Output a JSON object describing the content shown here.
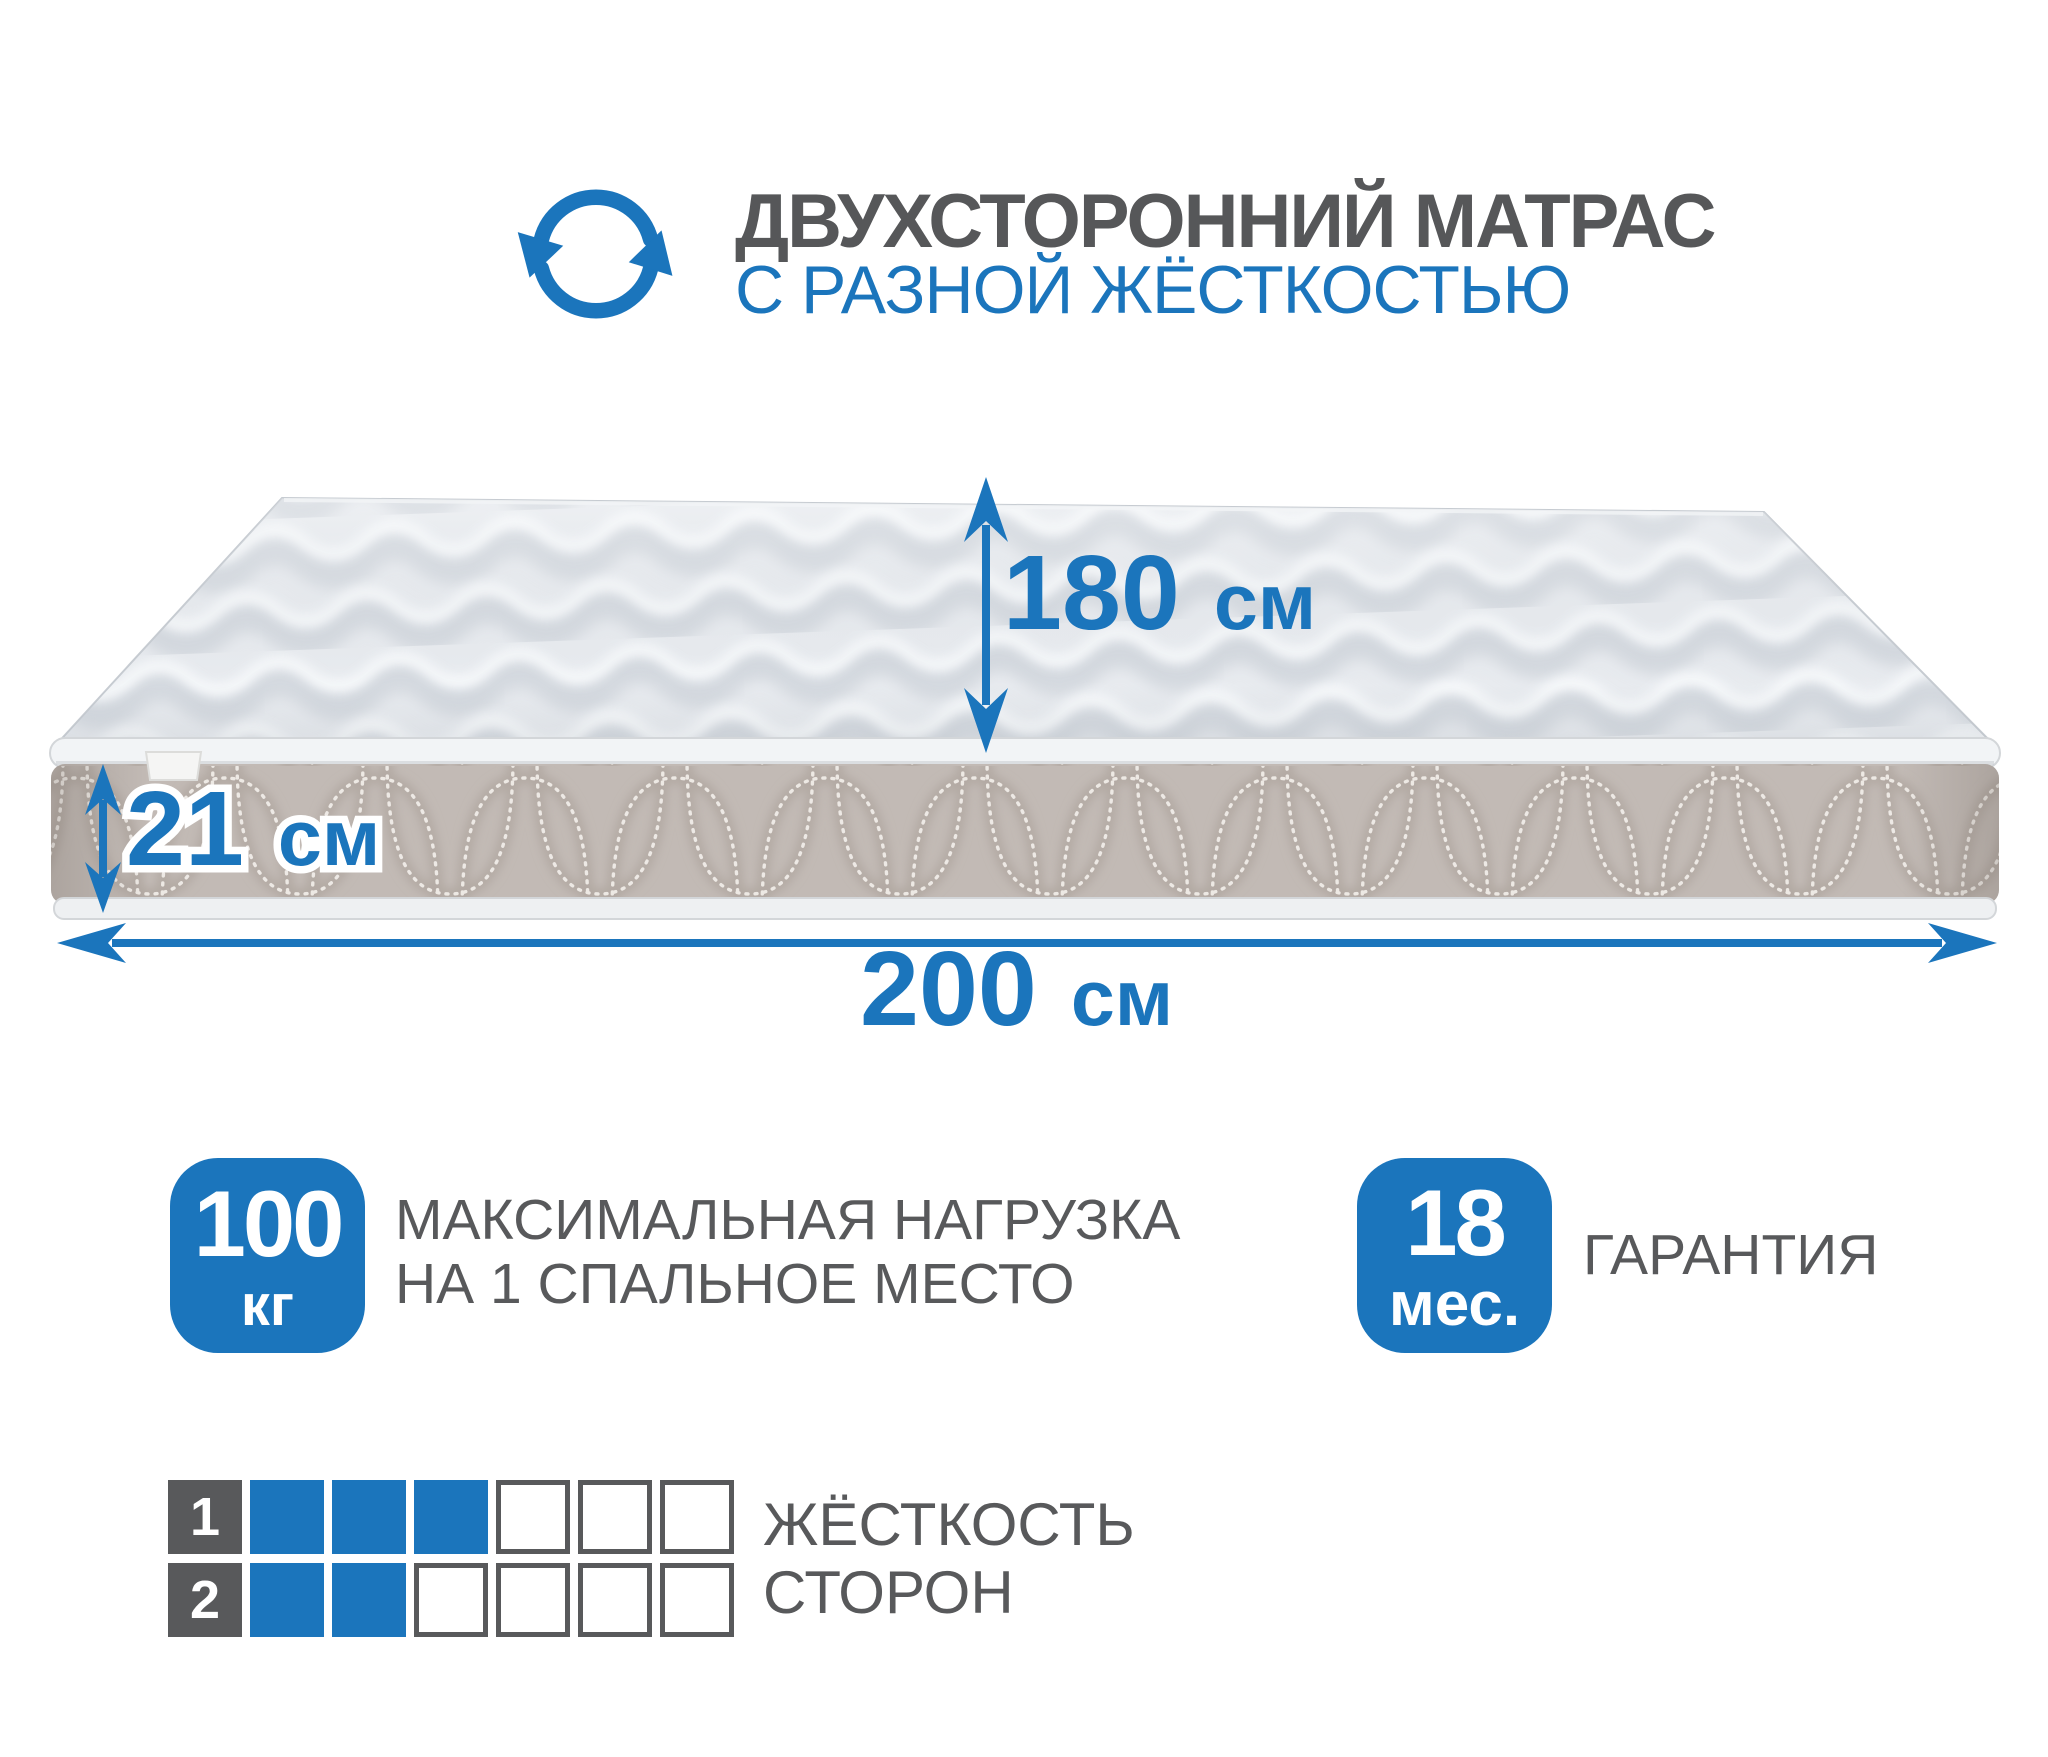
{
  "colors": {
    "accent": "#1b75bc",
    "text_gray": "#58595b"
  },
  "icons": {
    "header": "rotate-arrows-icon"
  },
  "header": {
    "title": "ДВУХСТОРОННИЙ МАТРАС",
    "subtitle": "С РАЗНОЙ ЖЁСТКОСТЬЮ"
  },
  "dimensions": {
    "width": {
      "value": "180",
      "unit": "см"
    },
    "height": {
      "value": "21",
      "unit": "см"
    },
    "length": {
      "value": "200",
      "unit": "см"
    }
  },
  "badges": {
    "max_load": {
      "value": "100",
      "unit": "кг",
      "label_line1": "МАКСИМАЛЬНАЯ НАГРУЗКА",
      "label_line2": "НА 1 СПАЛЬНОЕ МЕСТО"
    },
    "warranty": {
      "value": "18",
      "unit": "мес.",
      "label": "ГАРАНТИЯ"
    }
  },
  "firmness": {
    "label_line1": "ЖЁСТКОСТЬ",
    "label_line2": "СТОРОН",
    "scale_max": 6,
    "sides": [
      {
        "side": "1",
        "filled": 3
      },
      {
        "side": "2",
        "filled": 2
      }
    ]
  }
}
